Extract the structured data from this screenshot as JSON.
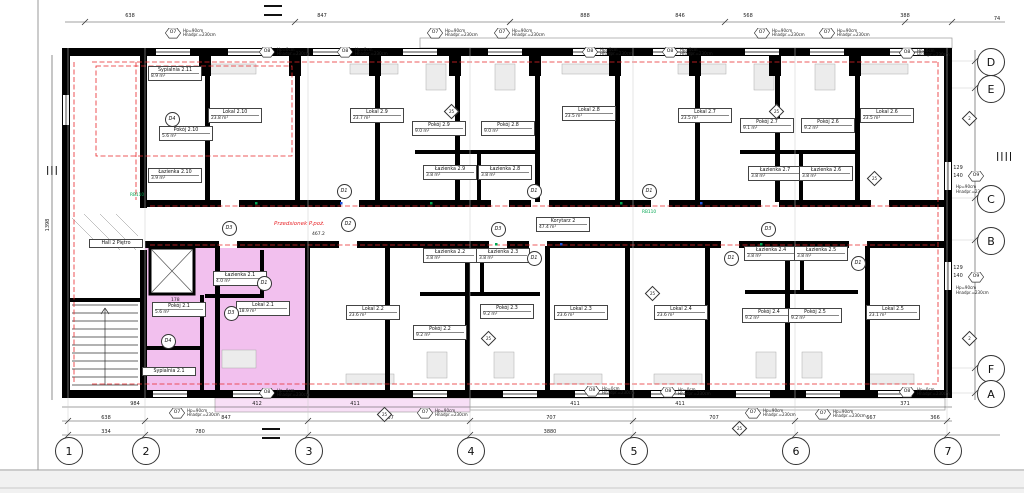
{
  "colors": {
    "wall": "#000000",
    "highlight": "#e98ce0",
    "highlight_light": "#f3c9ee",
    "red_dash": "#e8262a",
    "green": "#00a651"
  },
  "rooms": [
    {
      "name": "Sypialnia 2.11",
      "area": "8.9 m²",
      "x": 172,
      "y": 74
    },
    {
      "name": "Pokój 2.10",
      "area": "5.6 m²",
      "x": 183,
      "y": 134
    },
    {
      "name": "Łazienka 2.10",
      "area": "3.9 m²",
      "x": 172,
      "y": 176
    },
    {
      "name": "Lokal 2.10",
      "area": "23.8 m²",
      "x": 232,
      "y": 116
    },
    {
      "name": "Lokal 2.9",
      "area": "23.7 m²",
      "x": 374,
      "y": 116
    },
    {
      "name": "Pokój 2.9",
      "area": "9.0 m²",
      "x": 436,
      "y": 129
    },
    {
      "name": "Pokój 2.8",
      "area": "9.0 m²",
      "x": 505,
      "y": 129
    },
    {
      "name": "Łazienka 2.9",
      "area": "3.8 m²",
      "x": 447,
      "y": 173
    },
    {
      "name": "Łazienka 2.8",
      "area": "3.8 m²",
      "x": 502,
      "y": 173
    },
    {
      "name": "Lokal 2.8",
      "area": "23.5 m²",
      "x": 586,
      "y": 114
    },
    {
      "name": "Lokal 2.7",
      "area": "23.5 m²",
      "x": 702,
      "y": 116
    },
    {
      "name": "Pokój 2.7",
      "area": "9.1 m²",
      "x": 764,
      "y": 126
    },
    {
      "name": "Pokój 2.6",
      "area": "9.2 m²",
      "x": 825,
      "y": 126
    },
    {
      "name": "Łazienka 2.7",
      "area": "3.8 m²",
      "x": 772,
      "y": 174
    },
    {
      "name": "Łazienka 2.6",
      "area": "3.8 m²",
      "x": 823,
      "y": 174
    },
    {
      "name": "Lokal 2.6",
      "area": "23.5 m²",
      "x": 884,
      "y": 116
    },
    {
      "name": "Korytarz 2",
      "area": "47.4 m²",
      "x": 560,
      "y": 225
    },
    {
      "name": "Hall 2 Piętro",
      "area": "",
      "x": 113,
      "y": 244
    },
    {
      "name": "Łazienka 2.1",
      "area": "4.0 m²",
      "x": 237,
      "y": 279
    },
    {
      "name": "Pokój 2.1",
      "area": "5.6 m²",
      "x": 176,
      "y": 310
    },
    {
      "name": "Lokal 2.1",
      "area": "18.9 m²",
      "x": 260,
      "y": 309
    },
    {
      "name": "Sypialnia 2.1",
      "area": "",
      "x": 166,
      "y": 372
    },
    {
      "name": "Łazienka 2.2",
      "area": "3.8 m²",
      "x": 447,
      "y": 256
    },
    {
      "name": "Łazienka 2.3",
      "area": "3.8 m²",
      "x": 500,
      "y": 256
    },
    {
      "name": "Lokal 2.2",
      "area": "23.6 m²",
      "x": 370,
      "y": 313
    },
    {
      "name": "Pokój 2.2",
      "area": "9.2 m²",
      "x": 437,
      "y": 333
    },
    {
      "name": "Pokój 2.3",
      "area": "9.2 m²",
      "x": 504,
      "y": 312
    },
    {
      "name": "Lokal 2.3",
      "area": "23.6 m²",
      "x": 578,
      "y": 313
    },
    {
      "name": "Lokal 2.4",
      "area": "23.6 m²",
      "x": 678,
      "y": 313
    },
    {
      "name": "Pokój 2.4",
      "area": "9.2 m²",
      "x": 766,
      "y": 316
    },
    {
      "name": "Pokój 2.5",
      "area": "9.2 m²",
      "x": 812,
      "y": 316
    },
    {
      "name": "Łazienka 2.4",
      "area": "3.8 m²",
      "x": 768,
      "y": 254
    },
    {
      "name": "Łazienka 2.5",
      "area": "3.8 m²",
      "x": 818,
      "y": 254
    },
    {
      "name": "Lokal 2.5",
      "area": "23.1 m²",
      "x": 890,
      "y": 313
    }
  ],
  "vestibule": {
    "text": "Przedsionek P.poż.",
    "x": 302,
    "y": 225
  },
  "window_notes": {
    "sill90": "Hp=90cm",
    "sill0": "Hp=0cm",
    "head": "Hnadpr.=230cm"
  },
  "windows": [
    {
      "id": "O7",
      "x": 173,
      "y": 33,
      "sill": "90"
    },
    {
      "id": "O8",
      "x": 267,
      "y": 52,
      "sill": "0"
    },
    {
      "id": "O8",
      "x": 345,
      "y": 52,
      "sill": "0"
    },
    {
      "id": "O7",
      "x": 435,
      "y": 33,
      "sill": "90"
    },
    {
      "id": "O7",
      "x": 502,
      "y": 33,
      "sill": "90"
    },
    {
      "id": "O8",
      "x": 590,
      "y": 52,
      "sill": "0"
    },
    {
      "id": "O8",
      "x": 670,
      "y": 52,
      "sill": "0"
    },
    {
      "id": "O7",
      "x": 762,
      "y": 33,
      "sill": "90"
    },
    {
      "id": "O7",
      "x": 827,
      "y": 33,
      "sill": "90"
    },
    {
      "id": "O8",
      "x": 907,
      "y": 53,
      "sill": "0"
    },
    {
      "id": "O7",
      "x": 177,
      "y": 413,
      "sill": "90"
    },
    {
      "id": "O8",
      "x": 267,
      "y": 393,
      "sill": "0"
    },
    {
      "id": "O7",
      "x": 425,
      "y": 413,
      "sill": "90"
    },
    {
      "id": "O8",
      "x": 592,
      "y": 391,
      "sill": "0"
    },
    {
      "id": "O8",
      "x": 668,
      "y": 392,
      "sill": "0"
    },
    {
      "id": "O7",
      "x": 753,
      "y": 413,
      "sill": "90"
    },
    {
      "id": "O7",
      "x": 823,
      "y": 414,
      "sill": "90"
    },
    {
      "id": "O8",
      "x": 907,
      "y": 392,
      "sill": "0"
    },
    {
      "id": "O9",
      "x": 976,
      "y": 176,
      "sill": "90",
      "below": true
    },
    {
      "id": "O9",
      "x": 976,
      "y": 277,
      "sill": "90",
      "below": true
    }
  ],
  "doors": [
    {
      "id": "D4",
      "x": 171,
      "y": 118
    },
    {
      "id": "D3",
      "x": 228,
      "y": 227
    },
    {
      "id": "D2",
      "x": 347,
      "y": 223
    },
    {
      "id": "D3",
      "x": 497,
      "y": 228
    },
    {
      "id": "D1",
      "x": 533,
      "y": 190
    },
    {
      "id": "D1",
      "x": 533,
      "y": 257
    },
    {
      "id": "D3",
      "x": 767,
      "y": 228
    },
    {
      "id": "D1",
      "x": 730,
      "y": 257
    },
    {
      "id": "D1",
      "x": 857,
      "y": 262
    },
    {
      "id": "D1",
      "x": 263,
      "y": 282
    },
    {
      "id": "D3",
      "x": 230,
      "y": 312
    },
    {
      "id": "D4",
      "x": 167,
      "y": 340
    },
    {
      "id": "D1",
      "x": 343,
      "y": 190
    },
    {
      "id": "D1",
      "x": 648,
      "y": 190
    }
  ],
  "diamonds": [
    {
      "v": "25",
      "x": 450,
      "y": 110
    },
    {
      "v": "25",
      "x": 775,
      "y": 110
    },
    {
      "v": "2",
      "x": 968,
      "y": 117
    },
    {
      "v": "25",
      "x": 487,
      "y": 337
    },
    {
      "v": "25",
      "x": 651,
      "y": 292
    },
    {
      "v": "2",
      "x": 968,
      "y": 337
    },
    {
      "v": "25",
      "x": 383,
      "y": 413
    },
    {
      "v": "25",
      "x": 738,
      "y": 427
    },
    {
      "v": "25",
      "x": 873,
      "y": 177
    }
  ],
  "grid": {
    "bottom": [
      {
        "label": "1",
        "x": 68
      },
      {
        "label": "2",
        "x": 145
      },
      {
        "label": "3",
        "x": 308
      },
      {
        "label": "4",
        "x": 470
      },
      {
        "label": "5",
        "x": 633
      },
      {
        "label": "6",
        "x": 795
      },
      {
        "label": "7",
        "x": 947
      }
    ],
    "bottom_y": 450,
    "right": [
      {
        "label": "D",
        "y": 61
      },
      {
        "label": "E",
        "y": 88
      },
      {
        "label": "C",
        "y": 198
      },
      {
        "label": "B",
        "y": 240
      },
      {
        "label": "F",
        "y": 368
      },
      {
        "label": "A",
        "y": 393
      }
    ],
    "right_x": 990
  },
  "dims": {
    "top": [
      {
        "t": "638",
        "x": 130,
        "y": 16
      },
      {
        "t": "847",
        "x": 322,
        "y": 16
      },
      {
        "t": "888",
        "x": 585,
        "y": 16
      },
      {
        "t": "846",
        "x": 680,
        "y": 16
      },
      {
        "t": "568",
        "x": 748,
        "y": 16
      },
      {
        "t": "388",
        "x": 905,
        "y": 16
      },
      {
        "t": "74",
        "x": 997,
        "y": 19
      }
    ],
    "rowA": [
      {
        "t": "984",
        "x": 135,
        "y": 404
      },
      {
        "t": "412",
        "x": 257,
        "y": 404
      },
      {
        "t": "411",
        "x": 355,
        "y": 404
      },
      {
        "t": "411",
        "x": 575,
        "y": 404
      },
      {
        "t": "411",
        "x": 680,
        "y": 404
      },
      {
        "t": "371",
        "x": 905,
        "y": 404
      }
    ],
    "rowB": [
      {
        "t": "638",
        "x": 106,
        "y": 418
      },
      {
        "t": "847",
        "x": 226,
        "y": 418
      },
      {
        "t": "707",
        "x": 389,
        "y": 418
      },
      {
        "t": "707",
        "x": 551,
        "y": 418
      },
      {
        "t": "707",
        "x": 714,
        "y": 418
      },
      {
        "t": "667",
        "x": 871,
        "y": 418
      },
      {
        "t": "366",
        "x": 935,
        "y": 418
      }
    ],
    "rowC": [
      {
        "t": "334",
        "x": 106,
        "y": 432
      },
      {
        "t": "780",
        "x": 200,
        "y": 432
      },
      {
        "t": "3880",
        "x": 550,
        "y": 432
      }
    ],
    "right": [
      {
        "t": "129",
        "x": 958,
        "y": 168
      },
      {
        "t": "140",
        "x": 958,
        "y": 176
      },
      {
        "t": "129",
        "x": 958,
        "y": 268
      },
      {
        "t": "140",
        "x": 958,
        "y": 276
      }
    ],
    "left": [
      {
        "t": "1398",
        "x": 48,
        "y": 225,
        "rot": true
      }
    ]
  },
  "misc": [
    {
      "t": "467.2",
      "x": 312,
      "y": 232,
      "cls": "tiny"
    },
    {
      "t": "178",
      "x": 171,
      "y": 298,
      "cls": "tiny"
    },
    {
      "t": "RB110",
      "x": 130,
      "y": 193,
      "cls": "green"
    },
    {
      "t": "RB110",
      "x": 642,
      "y": 210,
      "cls": "green"
    },
    {
      "t": "|||",
      "x": 46,
      "y": 166,
      "cls": "section"
    },
    {
      "t": "||||",
      "x": 996,
      "y": 152,
      "cls": "section"
    },
    {
      "t": "",
      "x": 264,
      "y": 5,
      "cls": "equals"
    },
    {
      "t": "",
      "x": 262,
      "y": 428,
      "cls": "equals"
    }
  ]
}
